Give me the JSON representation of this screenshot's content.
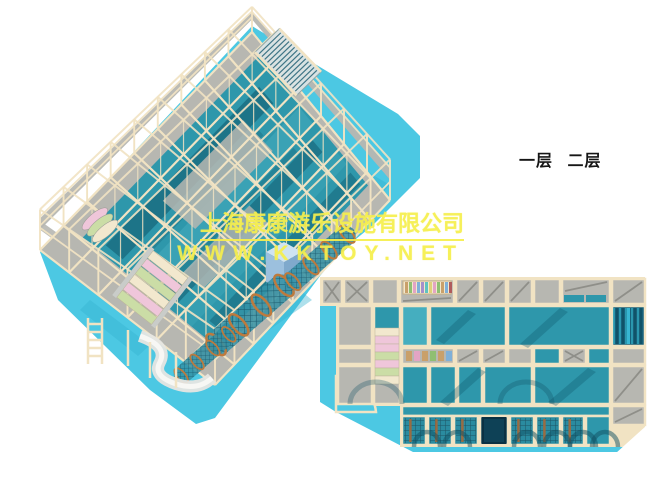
{
  "page": {
    "width": 650,
    "height": 500,
    "background": "#ffffff",
    "description": "3D renders of a two-level indoor playground: perspective view (top left) and top-down floor plan (bottom right)"
  },
  "annotations": {
    "floor_labels": [
      {
        "label": "一层"
      },
      {
        "label": "二层"
      }
    ]
  },
  "watermark": {
    "company_line": "上海康康游乐设施有限公司",
    "website_line": "WWW.KKTOY.NET",
    "text_color": "#f6ef4d"
  },
  "views": {
    "perspective": {
      "name": "two-level-playground-perspective-view"
    },
    "plan": {
      "name": "playground-floor-plan-view"
    }
  },
  "palette": {
    "frame_cream": "#f1e3c3",
    "frame_cream_light": "#f8efd9",
    "deck_gray": "#b7b7b1",
    "deck_gray_dark": "#8f8f89",
    "floor_teal": "#2e97ab",
    "floor_teal_light": "#45aebf",
    "floor_teal_dark": "#10586c",
    "mat_cyan": "#4cc8e3",
    "mat_cyan_dark": "#35b1cf",
    "stairs_pink": "#efc6da",
    "stairs_green": "#cbdda6",
    "stairs_cream": "#f2e8ce",
    "cube_blue": "#9cc0de",
    "tube_ring_orange": "#bd7a3d",
    "net_dark": "#155064",
    "ballpit_dark": "#17607a",
    "ballpit_navy": "#0e4156",
    "roller_colors": [
      "#c9a06a",
      "#8fbf72",
      "#e3a4c4",
      "#7fb0d8",
      "#a58fcb",
      "#5fc3c0",
      "#e0d07a",
      "#e3a4c4",
      "#8fbf72",
      "#c9a06a",
      "#7fb0d8",
      "#b05c5c"
    ]
  }
}
